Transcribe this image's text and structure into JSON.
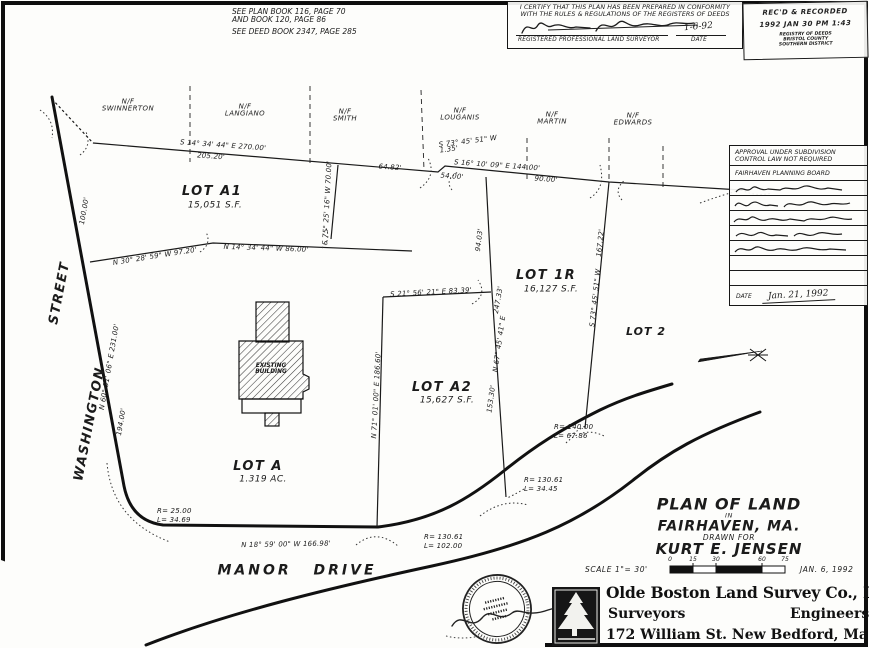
{
  "survey": {
    "notes": {
      "l1": "SEE PLAN BOOK 116, PAGE 70",
      "l2": "AND BOOK 120, PAGE 86",
      "l3": "SEE DEED BOOK 2347, PAGE 285"
    },
    "certification": {
      "line1": "I CERTIFY THAT THIS PLAN HAS BEEN PREPARED IN CONFORMITY",
      "line2": "WITH THE RULES & REGULATIONS OF THE REGISTERS OF DEEDS",
      "surveyor_label": "REGISTERED PROFESSIONAL LAND SURVEYOR",
      "date_label": "DATE",
      "date_value": "1-6-92"
    },
    "stamp": {
      "line1": "REC'D & RECORDED",
      "line2": "1992 JAN 30 PM 1:43",
      "line3": "REGISTRY OF DEEDS",
      "line4": "BRISTOL COUNTY",
      "line5": "SOUTHERN DISTRICT"
    },
    "approval": {
      "header1": "APPROVAL UNDER SUBDIVISION",
      "header2": "CONTROL LAW NOT REQUIRED",
      "board": "FAIRHAVEN PLANNING BOARD",
      "date_label": "DATE",
      "date_value": "Jan. 21, 1992"
    },
    "neighbors": [
      {
        "prefix": "N/F",
        "name": "SWINNERTON"
      },
      {
        "prefix": "N/F",
        "name": "LANGIANO"
      },
      {
        "prefix": "N/F",
        "name": "SMITH"
      },
      {
        "prefix": "N/F",
        "name": "LOUGANIS"
      },
      {
        "prefix": "N/F",
        "name": "MARTIN"
      },
      {
        "prefix": "N/F",
        "name": "EDWARDS"
      }
    ],
    "lots": {
      "a1": {
        "name": "LOT A1",
        "area": "15,051 S.F."
      },
      "r1": {
        "name": "LOT 1R",
        "area": "16,127 S.F."
      },
      "a2": {
        "name": "LOT A2",
        "area": "15,627 S.F."
      },
      "a": {
        "name": "LOT A",
        "area": "1.319 AC."
      },
      "lot2": {
        "name": "LOT 2"
      }
    },
    "building": {
      "l1": "EXISTING",
      "l2": "BUILDING"
    },
    "streets": {
      "washington": "WASHINGTON",
      "street": "STREET",
      "manor": "MANOR DRIVE"
    },
    "dims": {
      "d1": "S 14° 34' 44\" E   270.00'",
      "d2": "205.20'",
      "d3": "64.82'",
      "d4a": "S 73° 45' 51\" W",
      "d4b": "1.35'",
      "d5": "S 16° 10' 09\" E   144.00'",
      "d6": "54.00'",
      "d7": "90.00'",
      "d8": "N 30° 28' 59\" W   97.20'",
      "d9": "N 14° 34' 44\" W   86.00'",
      "d10": "S 75° 25' 16\" W   70.00'",
      "d11": "100.00'",
      "d12": "N 60° 31' 06\" E   231.00'",
      "d13": "194.00'",
      "d14": "94.03'",
      "d15": "247.33'",
      "d16": "N 67° 45' 41\" E",
      "d17": "153.30'",
      "d18": "167.22'",
      "d19": "S 73° 45' 51\" W",
      "d20": "S 21° 56' 21\" E   83.39'",
      "d21": "N 71° 01' 00\" E   186.60'",
      "d22": "N 18° 59' 00\" W   166.98'"
    },
    "curves": {
      "c1r": "R= 25.00",
      "c1l": "L= 34.69",
      "c2r": "R= 130.61",
      "c2l": "L= 102.00",
      "c3r": "R= 130.61",
      "c3l": "L= 34.45",
      "c4r": "R= 140.00",
      "c4l": "L= 67.86"
    },
    "title_block": {
      "title": "PLAN OF LAND",
      "in_word": "IN",
      "town": "FAIRHAVEN, MA.",
      "drawn_for": "DRAWN FOR",
      "client": "KURT E. JENSEN",
      "scale": "SCALE 1\"= 30'",
      "date": "JAN. 6, 1992",
      "ticks": [
        "0",
        "15",
        "30",
        "60",
        "75"
      ]
    },
    "company": {
      "name": "Olde Boston Land Survey Co., Inc.",
      "left": "Surveyors",
      "right": "Engineers",
      "address": "172 William St.   New Bedford, Ma."
    }
  }
}
